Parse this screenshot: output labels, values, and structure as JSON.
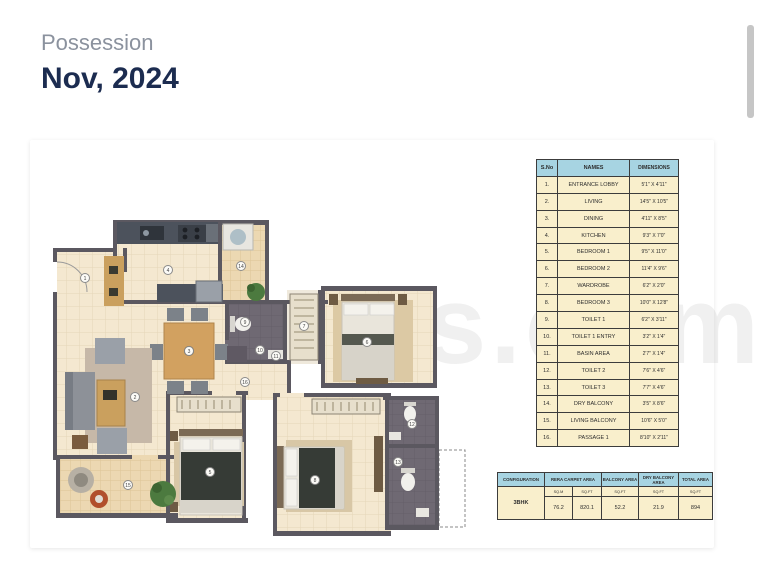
{
  "header": {
    "possession_label": "Possession",
    "possession_value": "Nov, 2024"
  },
  "watermark": "es.com",
  "plan_markers": [
    {
      "n": "1",
      "x": 45,
      "y": 128
    },
    {
      "n": "2",
      "x": 95,
      "y": 247
    },
    {
      "n": "3",
      "x": 149,
      "y": 201
    },
    {
      "n": "4",
      "x": 128,
      "y": 120
    },
    {
      "n": "5",
      "x": 170,
      "y": 322
    },
    {
      "n": "6",
      "x": 327,
      "y": 192
    },
    {
      "n": "7",
      "x": 264,
      "y": 176
    },
    {
      "n": "8",
      "x": 275,
      "y": 330
    },
    {
      "n": "9",
      "x": 205,
      "y": 172
    },
    {
      "n": "10",
      "x": 220,
      "y": 200
    },
    {
      "n": "11",
      "x": 236,
      "y": 206
    },
    {
      "n": "12",
      "x": 372,
      "y": 274
    },
    {
      "n": "13",
      "x": 358,
      "y": 312
    },
    {
      "n": "14",
      "x": 201,
      "y": 116
    },
    {
      "n": "15",
      "x": 88,
      "y": 335
    },
    {
      "n": "16",
      "x": 205,
      "y": 232
    }
  ],
  "room_table": {
    "headers": {
      "sno": "S.No",
      "name": "NAMES",
      "dim": "DIMENSIONS"
    },
    "rows": [
      {
        "sno": "1.",
        "name": "ENTRANCE LOBBY",
        "dim": "5'1\" X 4'11\""
      },
      {
        "sno": "2.",
        "name": "LIVING",
        "dim": "14'5\" X 10'5\""
      },
      {
        "sno": "3.",
        "name": "DINING",
        "dim": "4'11\" X 8'5\""
      },
      {
        "sno": "4.",
        "name": "KITCHEN",
        "dim": "9'3\" X 7'0\""
      },
      {
        "sno": "5.",
        "name": "BEDROOM 1",
        "dim": "9'5\" X 11'0\""
      },
      {
        "sno": "6.",
        "name": "BEDROOM 2",
        "dim": "11'4\" X 9'6\""
      },
      {
        "sno": "7.",
        "name": "WARDROBE",
        "dim": "6'2\" X 2'0\""
      },
      {
        "sno": "8.",
        "name": "BEDROOM 3",
        "dim": "10'0\" X 12'8\""
      },
      {
        "sno": "9.",
        "name": "TOILET 1",
        "dim": "6'2\" X 3'11\""
      },
      {
        "sno": "10.",
        "name": "TOILET 1 ENTRY",
        "dim": "3'2\" X 1'4\""
      },
      {
        "sno": "11.",
        "name": "BASIN AREA",
        "dim": "2'7\" X 1'4\""
      },
      {
        "sno": "12.",
        "name": "TOILET 2",
        "dim": "7'6\" X 4'6\""
      },
      {
        "sno": "13.",
        "name": "TOILET 3",
        "dim": "7'7\" X 4'6\""
      },
      {
        "sno": "14.",
        "name": "DRY BALCONY",
        "dim": "3'5\" X 8'6\""
      },
      {
        "sno": "15.",
        "name": "LIVING BALCONY",
        "dim": "10'6\" X 5'0\""
      },
      {
        "sno": "16.",
        "name": "PASSAGE 1",
        "dim": "8'10\" X 2'11\""
      }
    ]
  },
  "area_table": {
    "headers": {
      "configuration": "CONFIGURATION",
      "rera": "RERA CARPET AREA",
      "balcony": "BALCONY AREA",
      "dry_balcony": "DRY BALCONY AREA",
      "total": "TOTAL AREA"
    },
    "units": {
      "sqm": "SQ.M",
      "sqft1": "SQ.FT",
      "sqft2": "SQ.FT",
      "sqft3": "SQ.FT",
      "sqft4": "SQ.FT"
    },
    "row": {
      "configuration": "3BHK",
      "rera_sqm": "76.2",
      "rera_sqft": "820.1",
      "balcony_sqft": "52.2",
      "dry_balcony_sqft": "21.9",
      "total_sqft": "894"
    }
  },
  "colors": {
    "accent_navy": "#1c2c50",
    "table_header_blue": "#a7d4e2",
    "table_cell_cream": "#f9efcc",
    "wall_gray": "#5b5860"
  }
}
